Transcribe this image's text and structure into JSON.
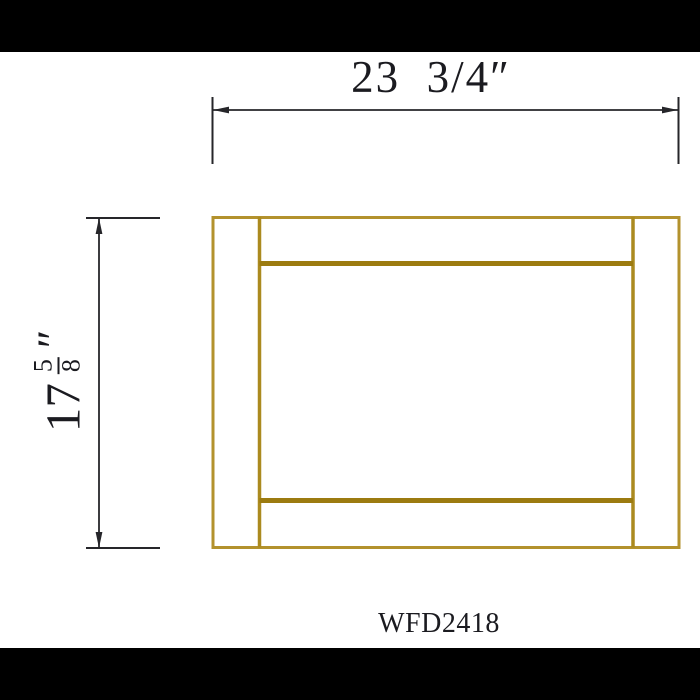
{
  "drawing": {
    "model_code": "WFD2418",
    "dimensions": {
      "width_label": "23  3/4″",
      "height_whole": "17",
      "height_frac_numerator": "5",
      "height_frac_denominator": "8",
      "height_unit": "″"
    }
  },
  "colors": {
    "frame_gold": "#b3922d",
    "frame_stile_gold": "#ab8a1f",
    "frame_rail_gold": "#9c7b10",
    "dimension_ink": "#26262a",
    "text_ink": "#1b1b20",
    "letterbox_black": "#000000",
    "background": "#ffffff"
  }
}
